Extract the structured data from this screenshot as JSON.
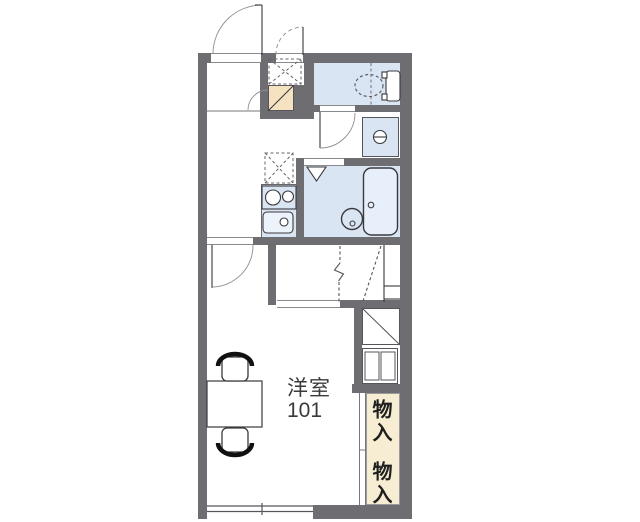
{
  "floorplan": {
    "room": {
      "name": "洋室",
      "number": "101"
    },
    "closets": [
      {
        "label": "物入"
      },
      {
        "label": "物入"
      }
    ],
    "colors": {
      "wall": "#6d6d72",
      "room_fill_blue": "#d9e5f2",
      "bathtub_fill": "#e7f0fa",
      "closet_fill_cream": "#f7edd3",
      "entry_step_fill": "#f5e2c0",
      "line": "#3a3a3e",
      "background": "#ffffff"
    },
    "icons": [
      "entrance-door-swing-icon",
      "outside-storage-door-swing-icon",
      "entry-step-icon",
      "toilet-icon",
      "toilet-door-swing-icon",
      "washing-machine-faucet-icon",
      "refrigerator-space-icon",
      "stove-icon",
      "sink-icon",
      "bath-folding-door-icon",
      "wash-basin-icon",
      "bathtub-icon",
      "loft-ladder-icon",
      "room-door-swing-icon",
      "table-icon",
      "chair-icon",
      "shelf-unit-icon",
      "sliding-window-icon"
    ]
  }
}
